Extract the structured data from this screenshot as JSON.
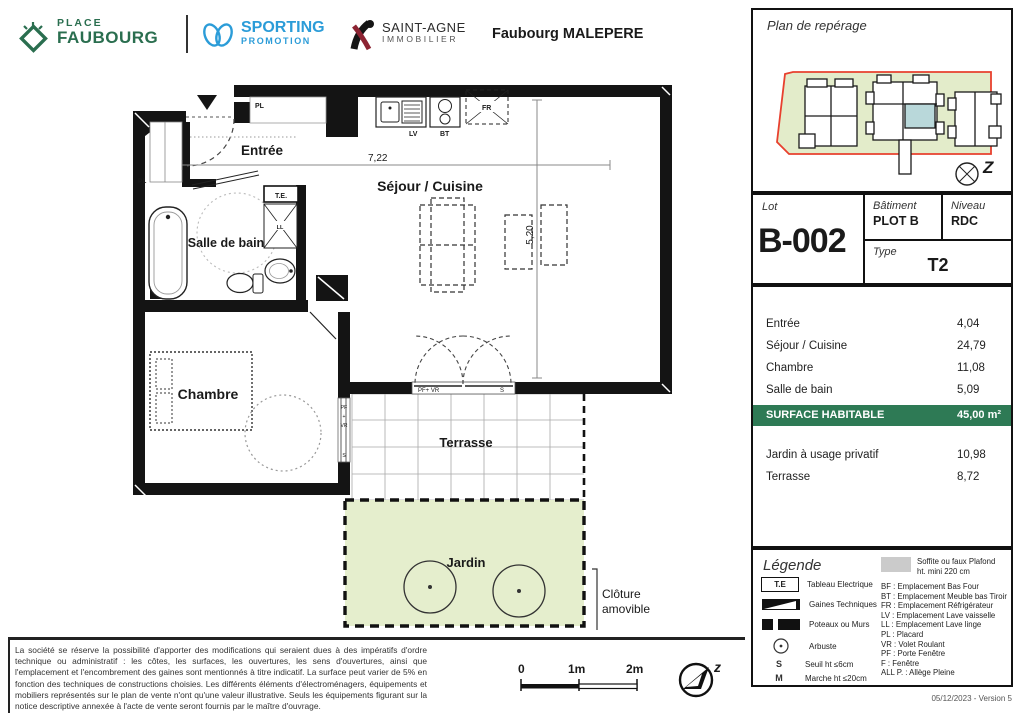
{
  "header": {
    "brand_place": {
      "top": "PLACE",
      "bottom": "FAUBOURG"
    },
    "brand_sporting": {
      "top": "SPORTING",
      "bottom": "PROMOTION"
    },
    "brand_saintagne": {
      "top": "SAINT-AGNE",
      "bottom": "IMMOBILIER"
    },
    "project": "Faubourg MALEPERE"
  },
  "plan": {
    "entree": "Entrée",
    "sejour": "Séjour / Cuisine",
    "salle_de_bain": "Salle de bain",
    "chambre": "Chambre",
    "terrasse": "Terrasse",
    "jardin": "Jardin",
    "cloture_1": "Clôture",
    "cloture_2": "amovible",
    "dim_w": "7,22",
    "dim_h": "5,20",
    "pl": "PL",
    "te": "T.E.",
    "ll": "LL",
    "lv": "LV",
    "bt": "BT",
    "fr": "FR",
    "pf_vr": "PF+ VR",
    "s": "S",
    "pf": "PF",
    "plus": "+",
    "vr": "VR"
  },
  "sidebar": {
    "reperage_title": "Plan de repérage",
    "compass_letter": "Z",
    "lot_label": "Lot",
    "lot_value": "B-002",
    "batiment_label": "Bâtiment",
    "batiment_value": "PLOT B",
    "niveau_label": "Niveau",
    "niveau_value": "RDC",
    "type_label": "Type",
    "type_value": "T2",
    "areas": [
      {
        "label": "Entrée",
        "value": "4,04"
      },
      {
        "label": "Séjour / Cuisine",
        "value": "24,79"
      },
      {
        "label": "Chambre",
        "value": "11,08"
      },
      {
        "label": "Salle de bain",
        "value": "5,09"
      }
    ],
    "total_label": "SURFACE HABITABLE",
    "total_value": "45,00 m²",
    "extras": [
      {
        "label": "Jardin à usage privatif",
        "value": "10,98"
      },
      {
        "label": "Terrasse",
        "value": "8,72"
      }
    ],
    "legend": {
      "title": "Légende",
      "items": [
        {
          "key": "T.E",
          "label": "Tableau Electrique"
        },
        {
          "key": "",
          "label": "Gaines Techniques"
        },
        {
          "key": "",
          "label": "Poteaux ou Murs"
        },
        {
          "key": "",
          "label": "Arbuste"
        },
        {
          "key": "S",
          "label": "Seuil ht ≤6cm"
        },
        {
          "key": "M",
          "label": "Marche ht ≤20cm"
        }
      ],
      "soffite_line1": "Soffite ou faux Plafond",
      "soffite_line2": "ht. mini 220 cm",
      "abbreviations": [
        "BF : Emplacement Bas Four",
        "BT : Emplacement Meuble bas Tiroir",
        "FR : Emplacement Réfrigérateur",
        "LV : Emplacement Lave vaisselle",
        "LL : Emplacement Lave linge",
        "PL : Placard",
        "VR : Volet Roulant",
        "PF : Porte Fenêtre",
        "F : Fenêtre",
        "ALL P. : Allège Pleine"
      ]
    },
    "version": "05/12/2023 - Version 5"
  },
  "footer": {
    "disclaimer": "La société se réserve la possibilité d'apporter des modifications qui seraient dues à des impératifs d'ordre technique ou administratif : les côtes, les surfaces, les ouvertures, les sens d'ouvertures, ainsi que l'emplacement et l'encombrement des gaines sont mentionnés à titre indicatif. La surface peut varier de 5% en fonction des techniques de constructions choisies. Les différents éléments d'électroménagers, équipements et mobiliers représentés sur le plan de vente n'ont qu'une valeur illustrative. Seuls les équipements figurant sur la notice descriptive annexée à l'acte de vente seront fournis par le maître d'ouvrage.",
    "scale_0": "0",
    "scale_1": "1m",
    "scale_2": "2m",
    "compass_letter": "z"
  },
  "colors": {
    "brand_green": "#2a6e4f",
    "brand_blue": "#2b9cd8",
    "banner_green": "#2e7a55",
    "garden_green": "#e5eecd",
    "unit_teal": "#b9d8da",
    "outline_red": "#e8402e"
  }
}
